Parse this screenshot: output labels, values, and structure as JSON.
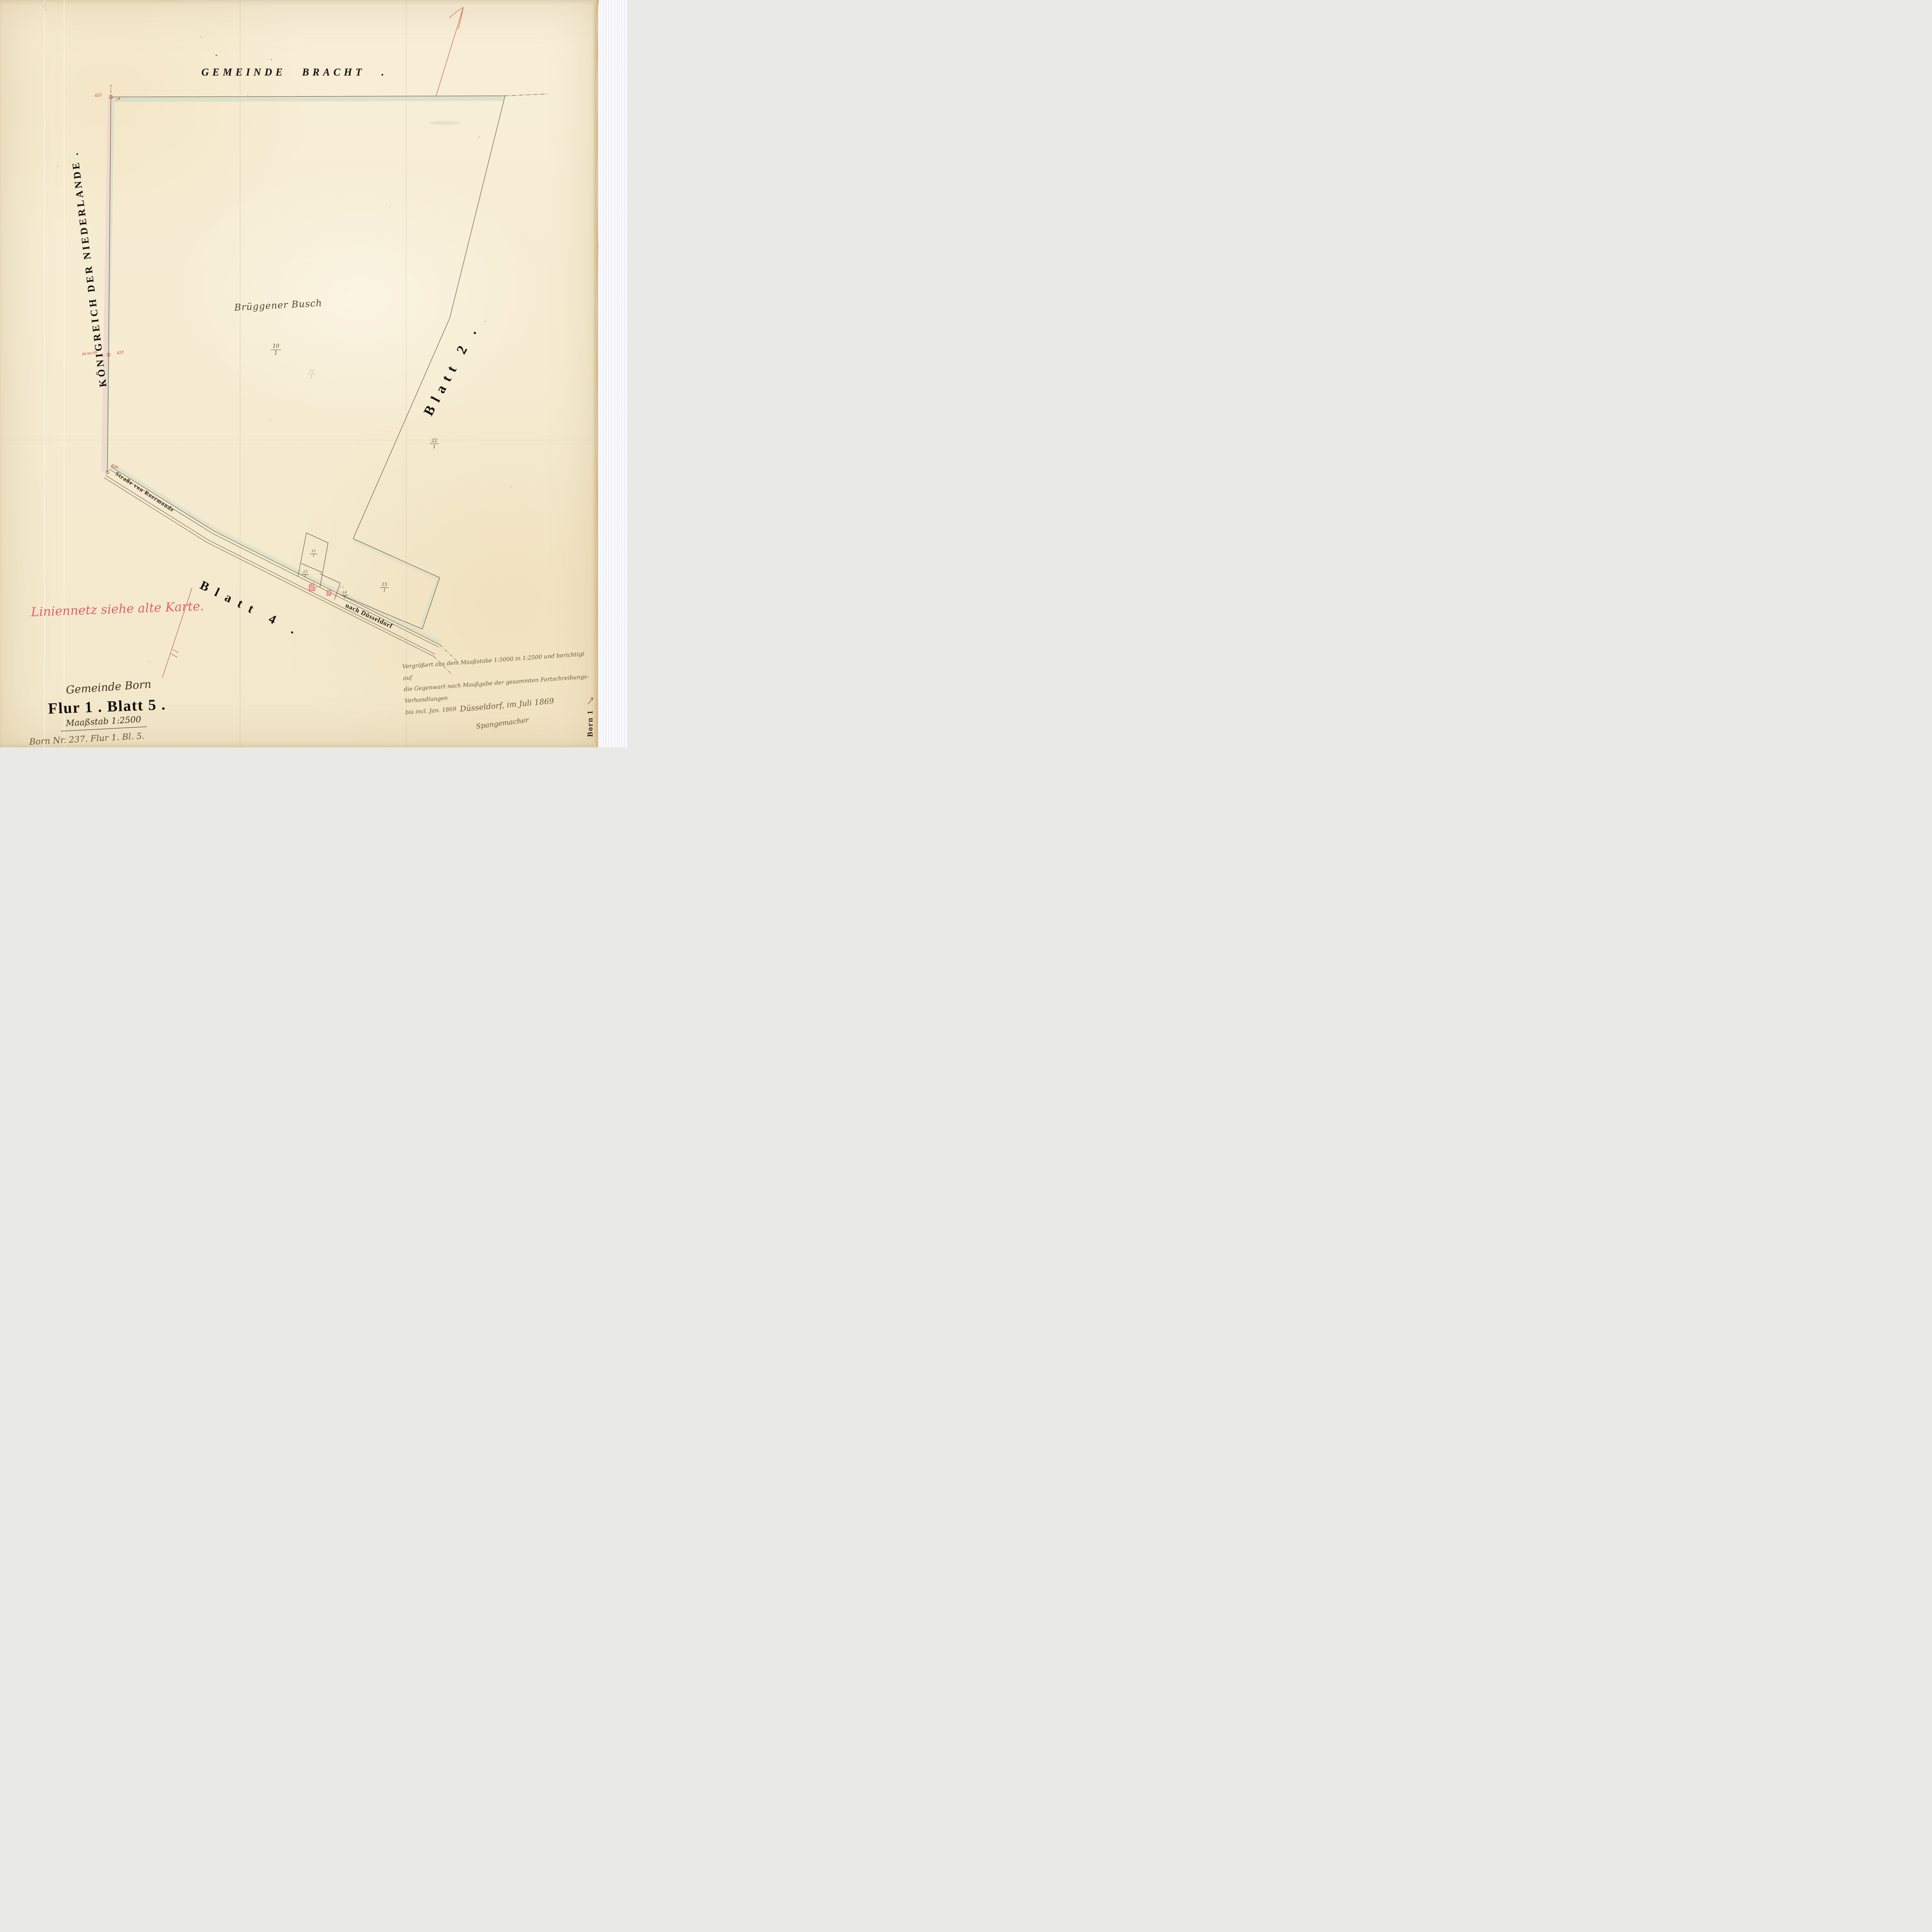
{
  "header": {
    "top_title": "GEMEINDE BRACHT .",
    "left_title": "KÖNIGREICH DER NIEDERLANDE ."
  },
  "labels": {
    "area_name": "Brüggener Busch",
    "sheet_right": "Blatt 2 .",
    "sheet_bottom": "Blatt 4 .",
    "road_from": "Straße von Roermonde",
    "road_to": "nach Düsseldorf",
    "red_note": "Liniennetz siehe alte Karte.",
    "edge_label": "Born 1"
  },
  "parcels": {
    "f10": {
      "numerator": "10",
      "denominator": "1"
    },
    "f10_pencil": {
      "numerator": "10",
      "denominator": "1"
    },
    "f22": {
      "numerator": "22",
      "denominator": "1"
    },
    "f11": {
      "numerator": "11",
      "denominator": "1"
    },
    "f13": {
      "numerator": "13",
      "denominator": "1"
    },
    "f14": {
      "numerator": "14",
      "denominator": "1"
    },
    "f14_pencil": "14",
    "f15": {
      "numerator": "15",
      "denominator": "1"
    }
  },
  "border_stones": {
    "stone_top": "422",
    "stone_mid_left": "80 bis 89",
    "stone_mid": "421",
    "stone_road": "420"
  },
  "cartouche": {
    "gemeinde": "Gemeinde Born",
    "flur": "Flur 1 . Blatt 5 .",
    "scale": "Maaßstab  1:2500",
    "archive_note": "Born Nr. 237.  Flur 1. Bl. 5."
  },
  "certification": {
    "line1": "Vergrößert aus dem Maaßstabe 1:5000 in 1:2500 und berichtigt auf",
    "line2": "die Gegenwart nach Maaßgabe der gesammten Fortschreibungs-Verhandlungen",
    "line3": "bis incl. Jan. 1869",
    "place_date": "Düsseldorf, im Juli 1869",
    "signature": "Spangemacher"
  },
  "colors": {
    "ink": "#4a3a28",
    "red_ink": "#c2352b",
    "rose_note": "#e2606e",
    "green_wash": "#ccdbc6",
    "pink_wash": "#f2ccd2",
    "building_fill": "#f2aab2",
    "building_outline": "#a43a42"
  }
}
